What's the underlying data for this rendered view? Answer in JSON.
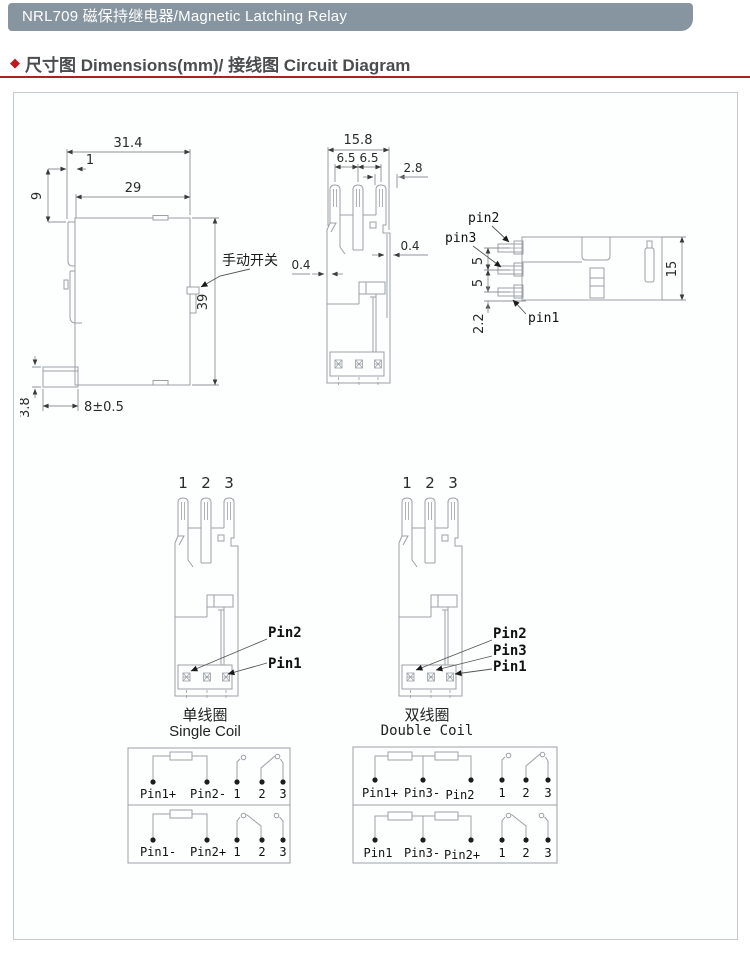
{
  "header": {
    "title": "NRL709 磁保持继电器/Magnetic Latching Relay"
  },
  "section": {
    "bullet": "◆",
    "title": "尺寸图 Dimensions(mm)/ 接线图 Circuit Diagram"
  },
  "colors": {
    "header_bg": "#8795a0",
    "accent_red": "#b01f24",
    "drawing_line": "#9aa1a6",
    "text": "#2a2a2a"
  },
  "side_view": {
    "dim_total_width": "31.4",
    "dim_pin_offset": "1",
    "dim_top_height": "9",
    "dim_body_width": "29",
    "dim_body_height": "39",
    "dim_foot_width": "8±0.5",
    "dim_foot_height": "3.8",
    "manual_switch": "手动开关"
  },
  "front_view": {
    "dim_total_width": "15.8",
    "dim_pitch_left": "6.5",
    "dim_pitch_right": "6.5",
    "dim_tab": "2.8",
    "dim_wall_left": "0.4",
    "dim_wall_right": "0.4"
  },
  "end_view": {
    "label_pin2": "pin2",
    "label_pin3": "pin3",
    "label_pin1": "pin1",
    "dim_gap_top": "5",
    "dim_gap_bottom": "5",
    "dim_offset": "2.2",
    "dim_height": "15"
  },
  "pinout_single": {
    "num1": "1",
    "num2": "2",
    "num3": "3",
    "label_pin2": "Pin2",
    "label_pin1": "Pin1",
    "caption_zh": "单线圈",
    "caption_en": "Single Coil"
  },
  "pinout_double": {
    "num1": "1",
    "num2": "2",
    "num3": "3",
    "label_pin2": "Pin2",
    "label_pin3": "Pin3",
    "label_pin1": "Pin1",
    "caption_zh": "双线圈",
    "caption_en": "Double Coil"
  },
  "circuit_single": {
    "row1": {
      "pin_left": "Pin1+",
      "pin_right": "Pin2-",
      "t1": "1",
      "t2": "2",
      "t3": "3"
    },
    "row2": {
      "pin_left": "Pin1-",
      "pin_right": "Pin2+",
      "t1": "1",
      "t2": "2",
      "t3": "3"
    }
  },
  "circuit_double": {
    "row1": {
      "pin_left": "Pin1+",
      "pin_mid": "Pin3-",
      "pin_right": "Pin2",
      "t1": "1",
      "t2": "2",
      "t3": "3"
    },
    "row2": {
      "pin_left": "Pin1",
      "pin_mid": "Pin3-",
      "pin_right": "Pin2+",
      "t1": "1",
      "t2": "2",
      "t3": "3"
    }
  }
}
